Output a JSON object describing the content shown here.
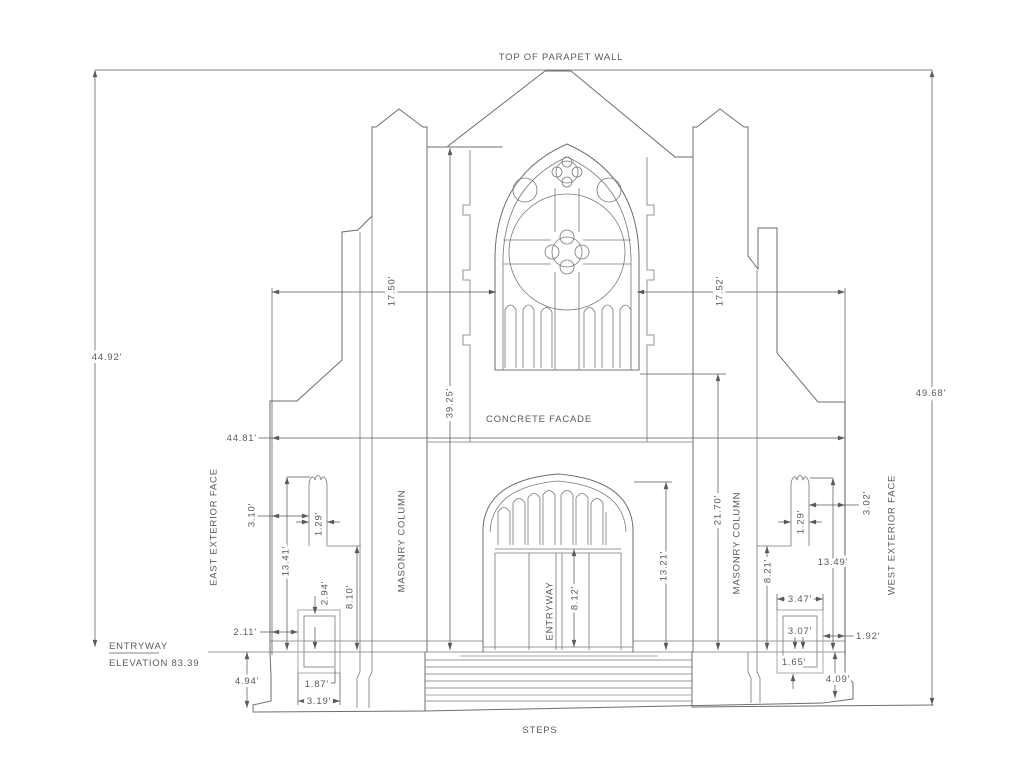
{
  "drawing": {
    "annotations": {
      "top_note": "TOP OF PARAPET WALL",
      "concrete_facade": "CONCRETE FACADE",
      "east_face": "EAST EXTERIOR FACE",
      "west_face": "WEST EXTERIOR FACE",
      "masonry_column": "MASONRY COLUMN",
      "entryway_door": "ENTRYWAY",
      "entry_level_name": "ENTRYWAY",
      "entry_level_elevation": "ELEVATION 83.39",
      "steps": "STEPS"
    },
    "dimensions": {
      "overall_height_east": "44.92'",
      "overall_height_west": "49.68'",
      "facade_width": "44.81'",
      "east_bay_width": "17.50'",
      "west_bay_width": "17.52'",
      "upper_wall_height": "39.25'",
      "lower_wall_height": "21.70'",
      "entry_arch_height": "13.21'",
      "entry_door_height": "8.12'",
      "east_pinnacle_height": "13.41'",
      "east_pinnacle_offset": "3.10'",
      "east_pinnacle_width": "1.29'",
      "east_ledge_height": "8.10'",
      "east_pedestal_panel_height": "2.94'",
      "east_pedestal_offset": "2.11'",
      "east_base_height": "4.94'",
      "east_pedestal_panel_width": "1.87'",
      "east_pedestal_width": "3.19'",
      "west_pinnacle_height": "13.49'",
      "west_pinnacle_offset": "3.02'",
      "west_pinnacle_width": "1.29'",
      "west_ledge_height": "8.21'",
      "west_pedestal_width": "3.47'",
      "west_pedestal_panel_height": "3.07'",
      "west_pedestal_offset": "1.92'",
      "west_pedestal_panel_depth": "1.65'",
      "west_base_height": "4.09'"
    },
    "colors": {
      "line": "#6e6e6e",
      "light_line": "#a8a8a8",
      "text": "#5a5a5a",
      "background": "#ffffff"
    }
  }
}
